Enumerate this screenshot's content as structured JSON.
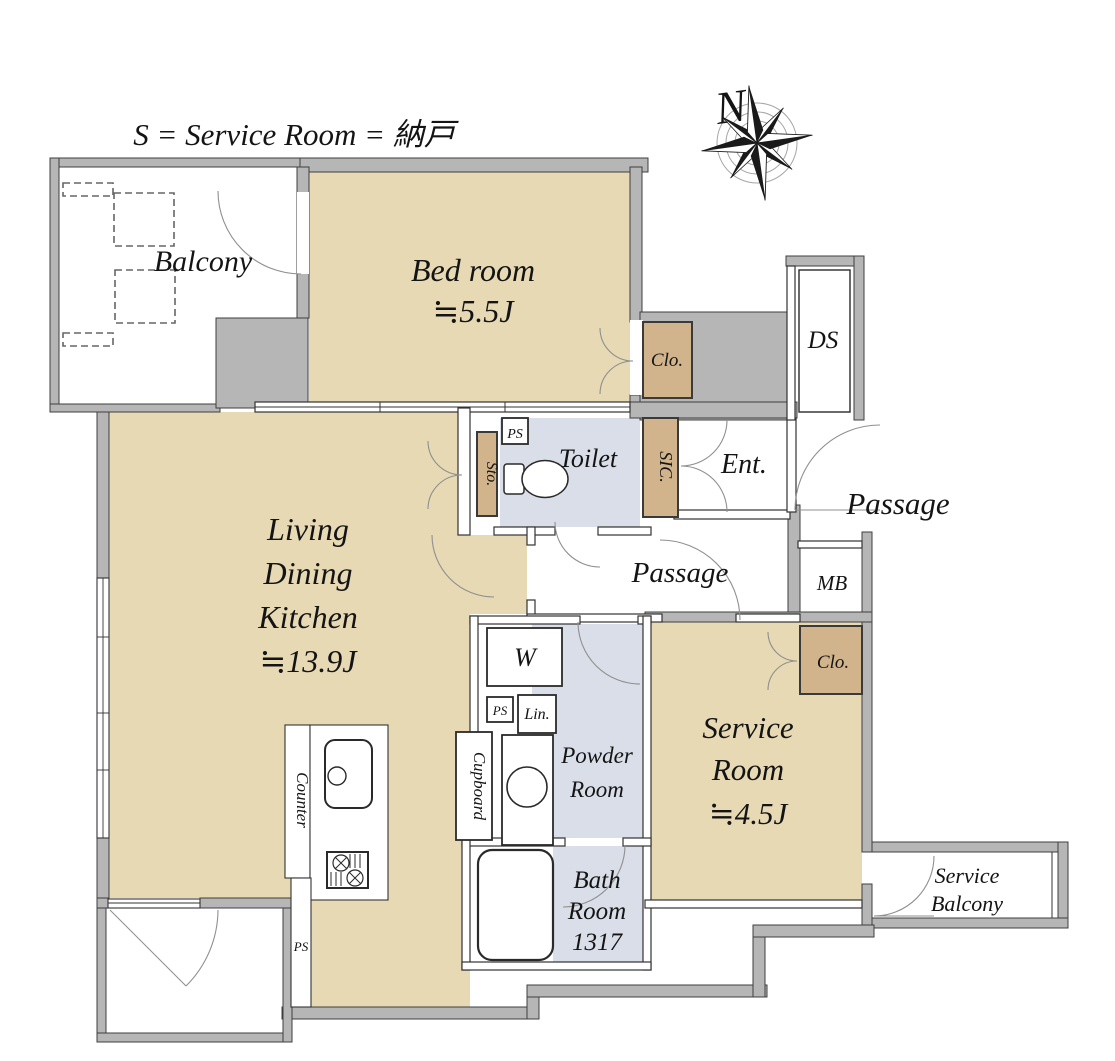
{
  "legend": {
    "text": "S = Service Room = 納戸"
  },
  "compass": {
    "north_label": "N"
  },
  "rooms": {
    "balcony": {
      "name": "Balcony"
    },
    "bedroom": {
      "name": "Bed room",
      "area": "≒5.5J"
    },
    "living_dining_kitchen": {
      "name_line1": "Living",
      "name_line2": "Dining",
      "name_line3": "Kitchen",
      "area": "≒13.9J"
    },
    "service_room": {
      "name_line1": "Service",
      "name_line2": "Room",
      "area": "≒4.5J"
    },
    "toilet": {
      "name": "Toilet"
    },
    "powder_room": {
      "name_line1": "Powder",
      "name_line2": "Room"
    },
    "bath_room": {
      "name_line1": "Bath",
      "name_line2": "Room",
      "size": "1317"
    },
    "entrance": {
      "name": "Ent."
    },
    "passage_outer": {
      "name": "Passage"
    },
    "passage_inner": {
      "name": "Passage"
    },
    "service_balcony": {
      "name_line1": "Service",
      "name_line2": "Balcony"
    }
  },
  "features": {
    "closet_bedroom": "Clo.",
    "closet_service": "Clo.",
    "duct_space": "DS",
    "meter_box": "MB",
    "shoes_in_closet": "SIC.",
    "storage": "Sto.",
    "pipe_space": "PS",
    "washer": "W",
    "linen": "Lin.",
    "cupboard": "Cupboard",
    "counter": "Counter"
  },
  "colors": {
    "wall": "#b6b6b6",
    "room": "#e6d9b4",
    "closet": "#d2b48c",
    "wet_area": "#d9dee9",
    "line": "#333333"
  }
}
